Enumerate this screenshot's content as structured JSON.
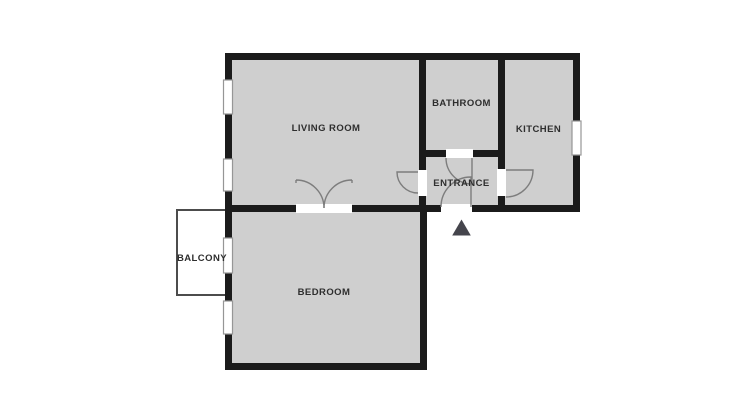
{
  "floor_plan": {
    "title": "apartment-floor-plan",
    "rooms": {
      "living_room": {
        "label": "LIVING ROOM"
      },
      "bathroom": {
        "label": "BATHROOM"
      },
      "kitchen": {
        "label": "KITCHEN"
      },
      "entrance": {
        "label": "ENTRANCE"
      },
      "bedroom": {
        "label": "BEDROOM"
      },
      "balcony": {
        "label": "BALCONY"
      }
    },
    "icons": {
      "entrance_arrow": "triangle-up-icon"
    },
    "counts": {
      "windows": 5,
      "interior_doors": 4,
      "entry_doors": 1,
      "double_doors": 1
    },
    "colors": {
      "background": "#ffffff",
      "room_fill": "#cfcfcf",
      "wall": "#1b1b1b",
      "opening_fill": "#ffffff",
      "window_fill": "#ffffff",
      "window_border": "#969696",
      "balcony_fill": "#ffffff",
      "balcony_border": "#4c4c4c",
      "door_arc": "#7d7d7d",
      "arrow": "#45454c",
      "label_text": "#2e2e2e"
    }
  }
}
